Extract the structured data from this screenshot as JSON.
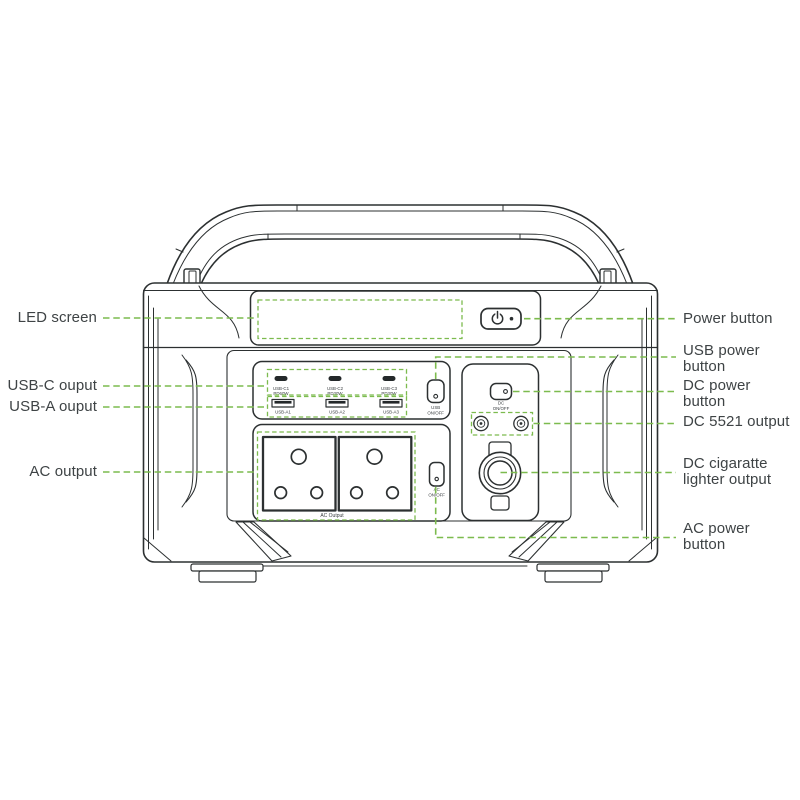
{
  "colors": {
    "outline": "#2c3031",
    "accent_green": "#7cbb4e",
    "label_text": "#3e4345",
    "port_fill": "#24282a"
  },
  "callouts": {
    "left": [
      {
        "id": "led-screen",
        "lines": [
          "LED screen"
        ]
      },
      {
        "id": "usb-c-output",
        "lines": [
          "USB-C ouput"
        ]
      },
      {
        "id": "usb-a-output",
        "lines": [
          "USB-A ouput"
        ]
      },
      {
        "id": "ac-output",
        "lines": [
          "AC output"
        ]
      }
    ],
    "right": [
      {
        "id": "power-button",
        "lines": [
          "Power button"
        ]
      },
      {
        "id": "usb-power-button",
        "lines": [
          "USB power",
          "button"
        ]
      },
      {
        "id": "dc-power-button",
        "lines": [
          "DC power",
          "button"
        ]
      },
      {
        "id": "dc-5521-output",
        "lines": [
          "DC 5521 output"
        ]
      },
      {
        "id": "dc-cigarette-lighter-output",
        "lines": [
          "DC cigaratte",
          "lighter output"
        ]
      },
      {
        "id": "ac-power-button",
        "lines": [
          "AC power",
          "button"
        ]
      }
    ]
  },
  "device": {
    "usb_c_ports": [
      {
        "name": "USB-C1",
        "power": "PD60W"
      },
      {
        "name": "USB-C2",
        "power": "PD30W"
      },
      {
        "name": "USB-C3",
        "power": "PD30W"
      }
    ],
    "usb_a_ports": [
      {
        "name": "USB-A1"
      },
      {
        "name": "USB-A2"
      },
      {
        "name": "USB-A3"
      }
    ],
    "usb_power_button": {
      "line1": "USB",
      "line2": "ON/OFF"
    },
    "dc_power_button": {
      "line1": "DC",
      "line2": "ON/OFF"
    },
    "ac_power_button": {
      "line1": "AC",
      "line2": "ON/OFF"
    },
    "ac_output_label": "AC Output"
  }
}
